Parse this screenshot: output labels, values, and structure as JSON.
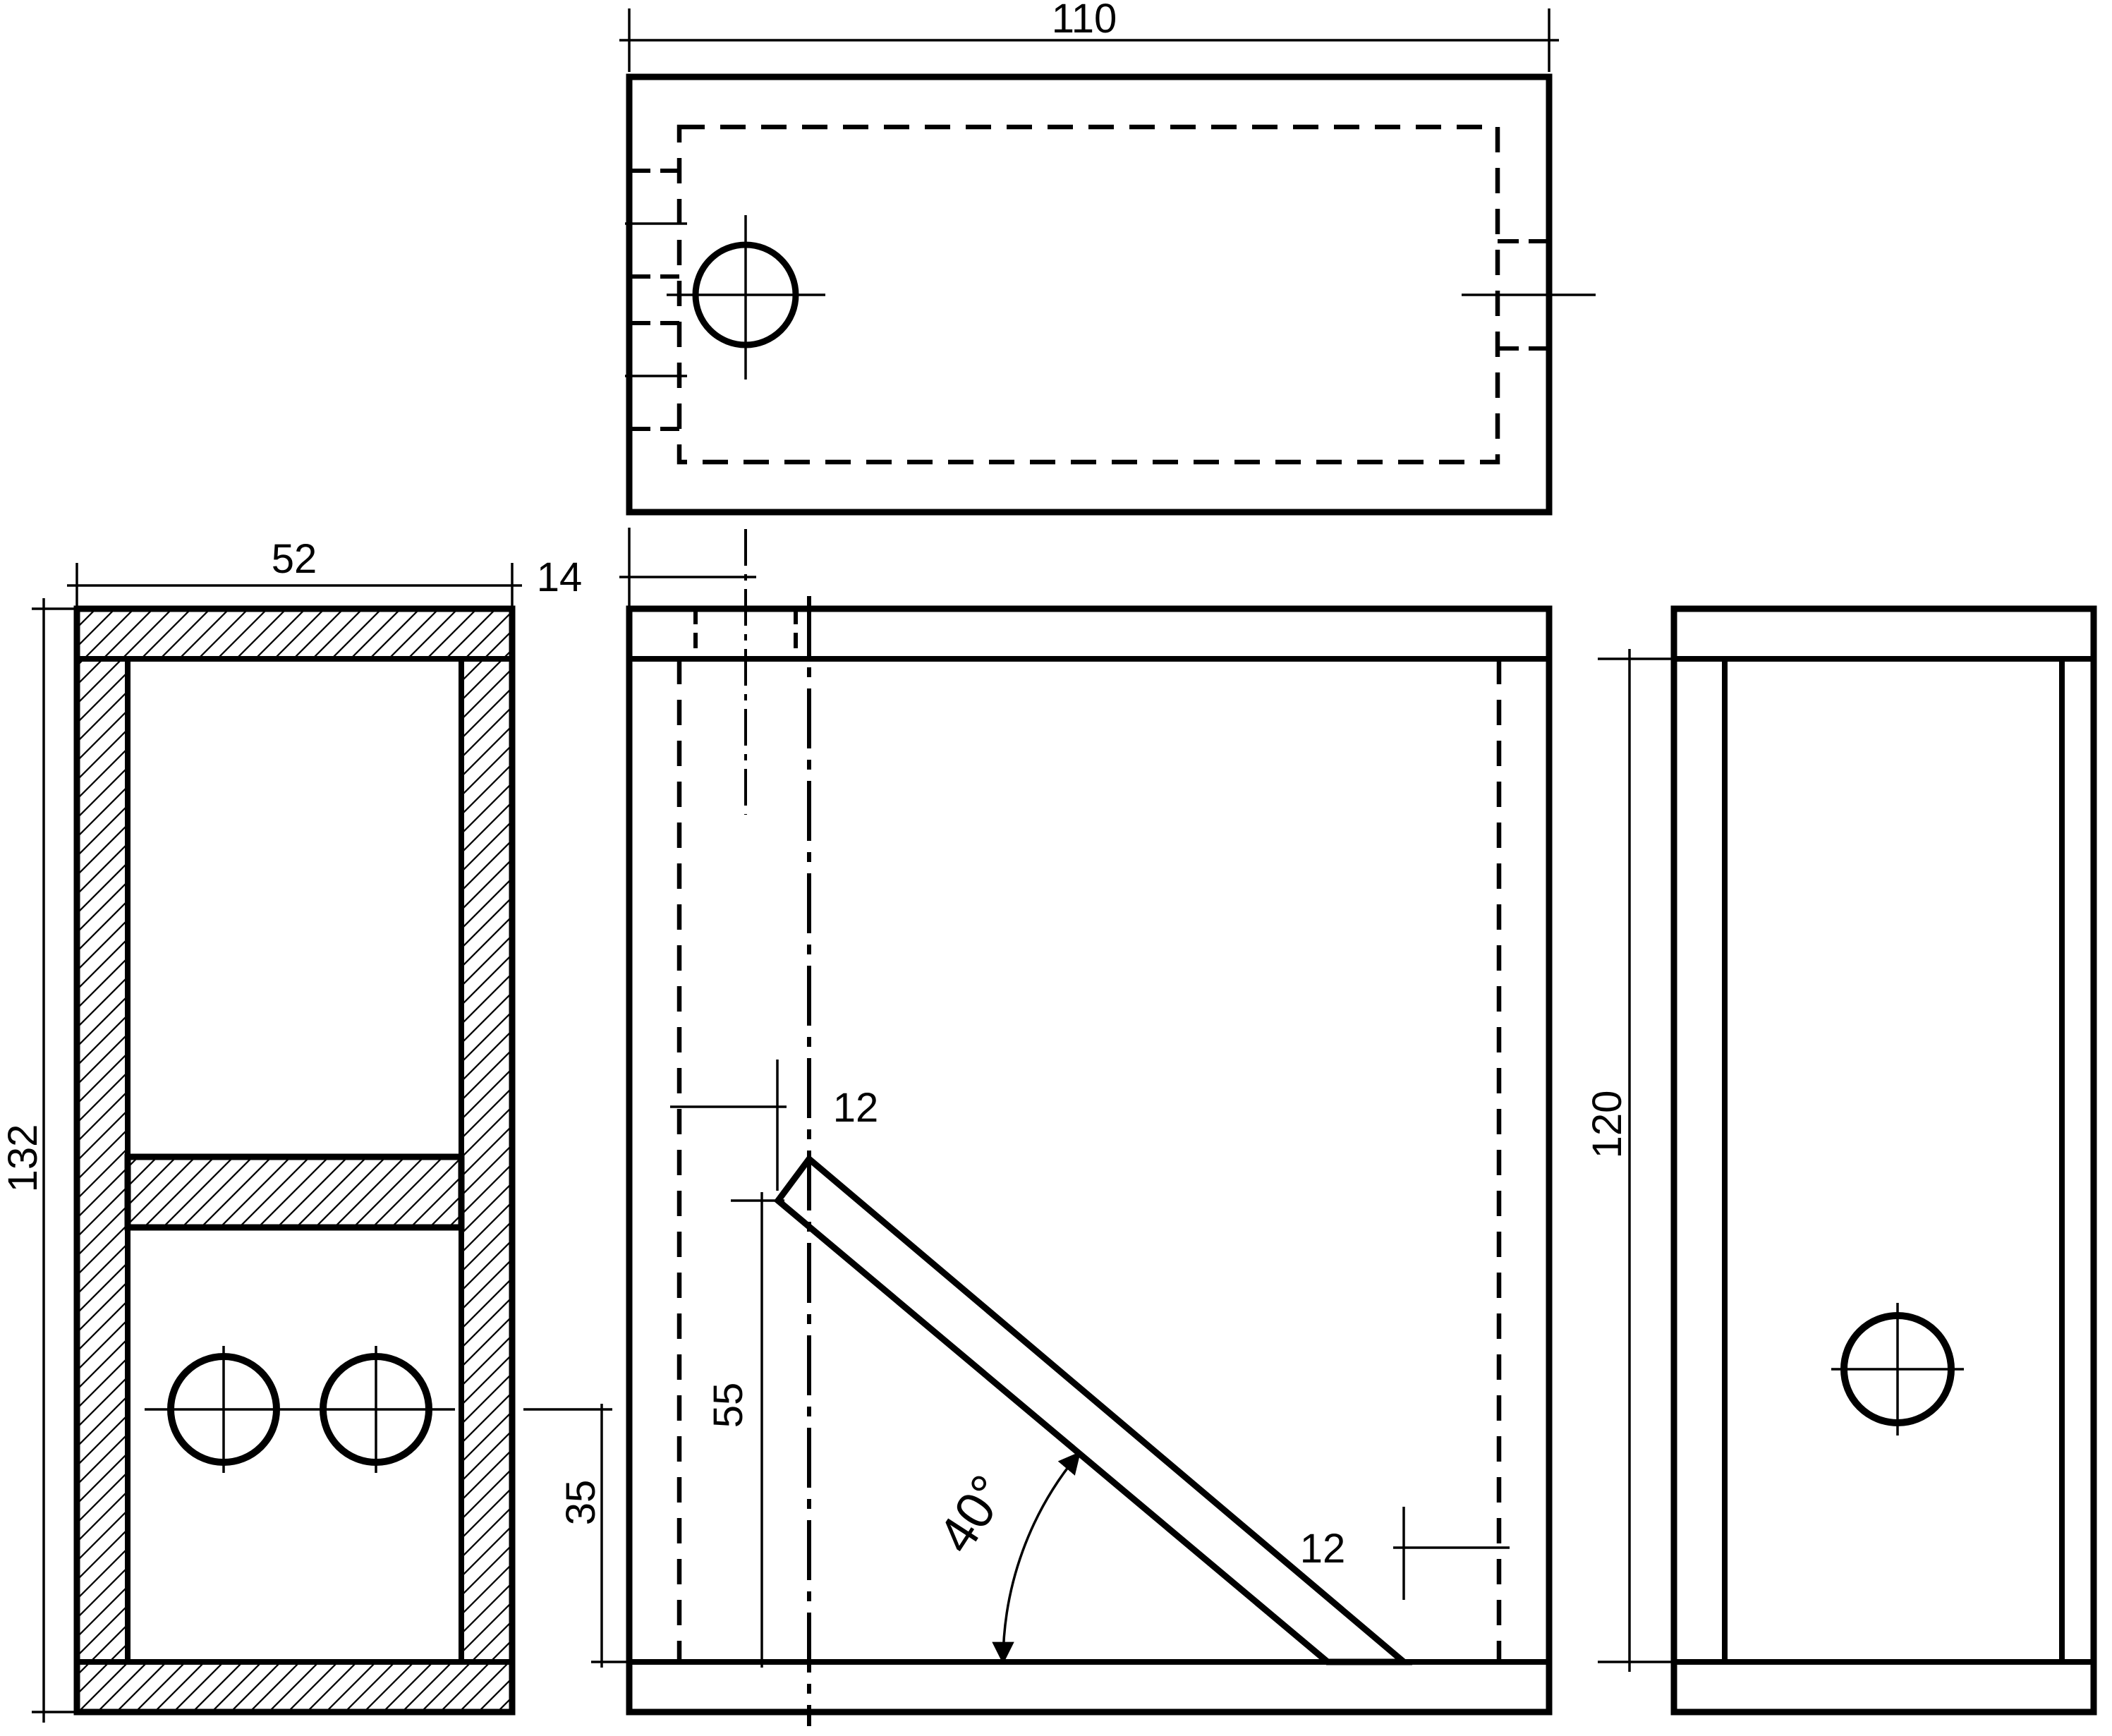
{
  "canvas": {
    "background": "#ffffff",
    "line_color": "#000000"
  },
  "dimensions": {
    "overall_width": "110",
    "depth": "52",
    "hole_offset": "14",
    "overall_height": "132",
    "slot_width": "12",
    "tip_height": "55",
    "hole_height": "35",
    "board_angle": "40°",
    "bottom_gap": "12",
    "inner_height": "120"
  }
}
